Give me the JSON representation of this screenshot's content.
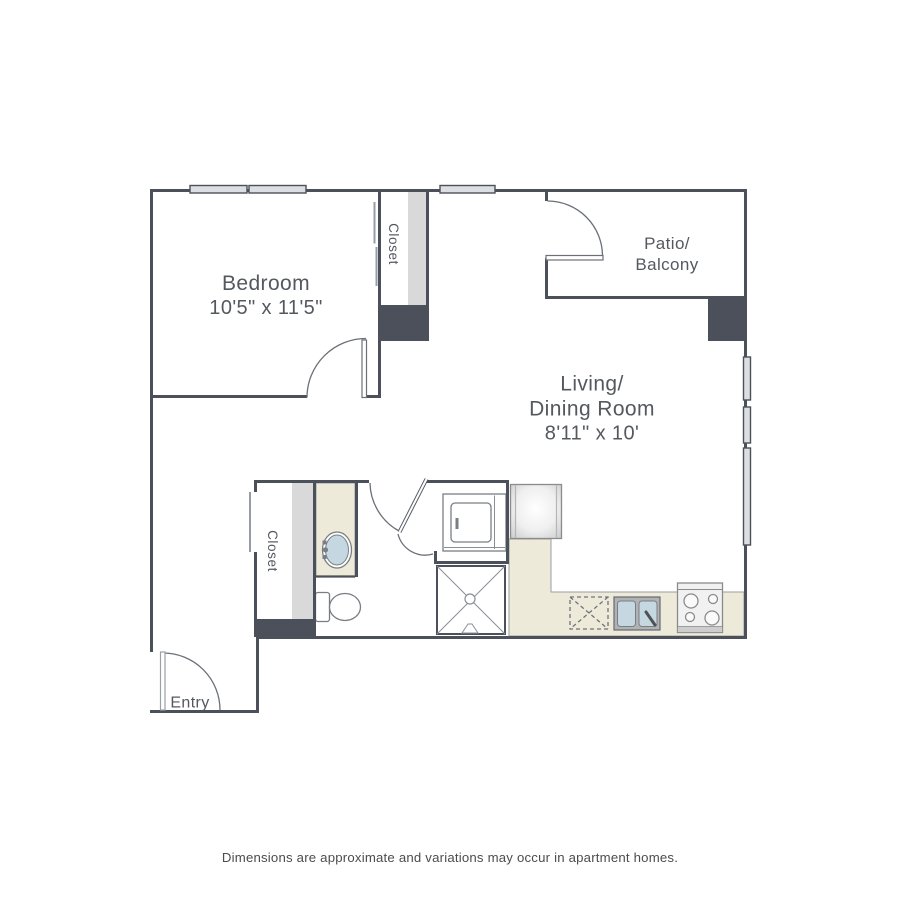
{
  "colors": {
    "wall": "#4b505a",
    "text": "#54585f",
    "counter": "#edead9",
    "strip": "#d9d9d9",
    "window": "#dbdfe3",
    "basin": "#c5d8e1"
  },
  "rooms": {
    "bedroom": {
      "label": "Bedroom",
      "dims": "10'5\" x 11'5\""
    },
    "living": {
      "line1": "Living/",
      "line2": "Dining Room",
      "dims": "8'11\" x 10'"
    },
    "patio": {
      "line1": "Patio/",
      "line2": "Balcony"
    },
    "bedroom_closet": {
      "label": "Closet"
    },
    "bathroom_closet": {
      "label": "Closet"
    },
    "entry": {
      "label": "Entry"
    }
  },
  "footer": {
    "disclaimer": "Dimensions are approximate and variations may occur in apartment homes."
  }
}
